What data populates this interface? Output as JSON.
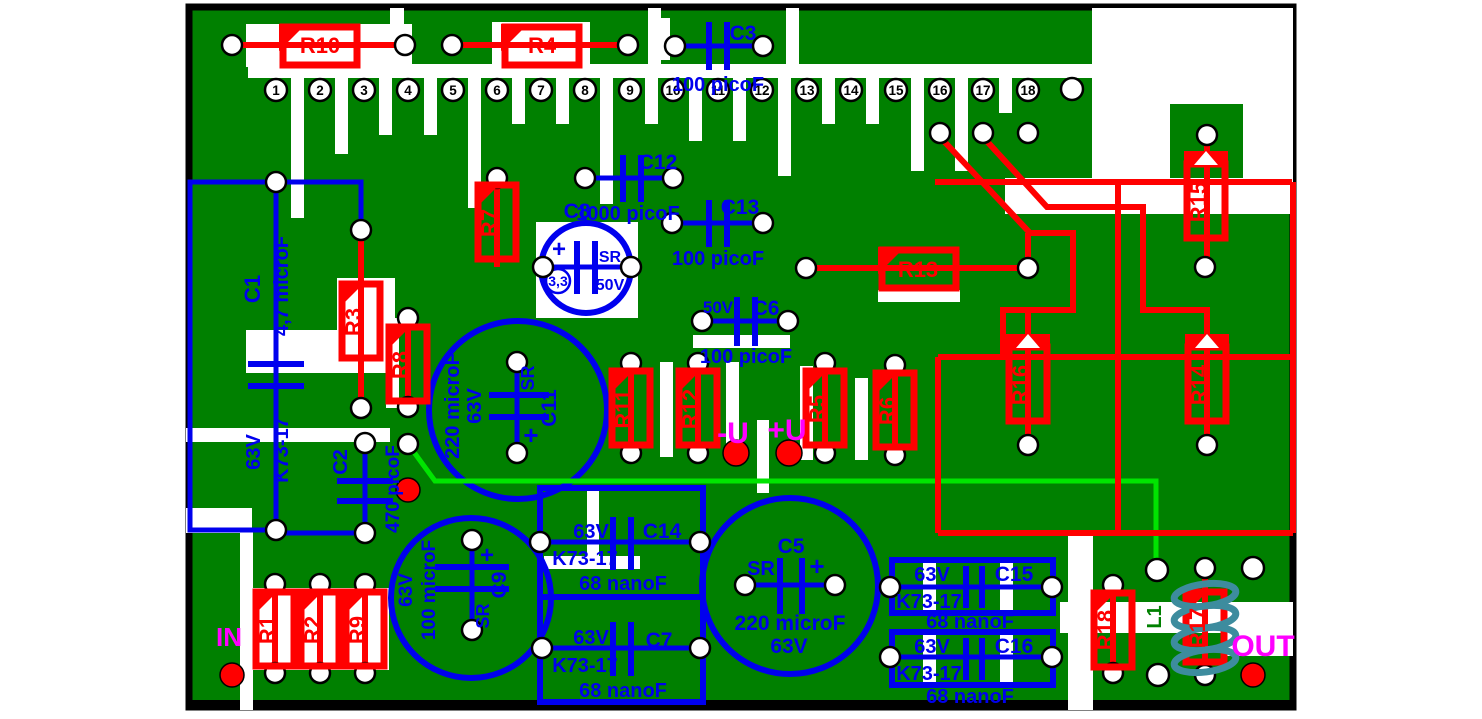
{
  "board": {
    "type": "pcb-component-layout",
    "colors": {
      "board_green": "#008000",
      "isolation_white": "#FFFFFF",
      "top_layer_red": "#FF0000",
      "bottom_layer_blue": "#0000EE",
      "jumper_green": "#00E400",
      "io_magenta": "#FF00FF",
      "pale_green_pad": "#CCFFCC",
      "coil_teal": "#3D8C9E",
      "border_black": "#000000"
    }
  },
  "pins": [
    {
      "n": "1",
      "fill": "#FF0000"
    },
    {
      "n": "2",
      "fill": "#FFFFFF"
    },
    {
      "n": "3",
      "fill": "#FFFFFF"
    },
    {
      "n": "4",
      "fill": "#FFFFFF"
    },
    {
      "n": "5",
      "fill": "#FFFFFF"
    },
    {
      "n": "6",
      "fill": "#FFFFFF"
    },
    {
      "n": "7",
      "fill": "#FFFFFF"
    },
    {
      "n": "8",
      "fill": "#CCFFCC"
    },
    {
      "n": "9",
      "fill": "#FFFFFF"
    },
    {
      "n": "10",
      "fill": "#FFFFFF"
    },
    {
      "n": "11",
      "fill": "#CCFFCC"
    },
    {
      "n": "12",
      "fill": "#FFFFFF"
    },
    {
      "n": "13",
      "fill": "#FF00FF"
    },
    {
      "n": "14",
      "fill": "#FFFFFF"
    },
    {
      "n": "15",
      "fill": "#FFFFFF"
    },
    {
      "n": "16",
      "fill": "#FF00FF"
    },
    {
      "n": "17",
      "fill": "#FF00FF"
    },
    {
      "n": "18",
      "fill": "#FF00FF"
    }
  ],
  "resistors": {
    "r1": {
      "label": "R1"
    },
    "r2": {
      "label": "R2"
    },
    "r3": {
      "label": "R3"
    },
    "r4": {
      "label": "R4"
    },
    "r5": {
      "label": "R5"
    },
    "r6": {
      "label": "R6"
    },
    "r7": {
      "label": "R7"
    },
    "r8": {
      "label": "R8"
    },
    "r9": {
      "label": "R9"
    },
    "r10": {
      "label": "R10"
    },
    "r11": {
      "label": "R11"
    },
    "r12": {
      "label": "R12"
    },
    "r13": {
      "label": "R13"
    },
    "r14": {
      "label": "R14"
    },
    "r15": {
      "label": "R15"
    },
    "r16": {
      "label": "R16"
    },
    "r17": {
      "label": "R17"
    },
    "r18": {
      "label": "R18"
    }
  },
  "capacitors": {
    "c1": {
      "name": "C1",
      "value": "4,7 microF",
      "voltage": "63V",
      "type": "K73-17"
    },
    "c2": {
      "name": "C2",
      "value": "470 picoF"
    },
    "c3": {
      "name": "C3",
      "value": "100 picoF"
    },
    "c5": {
      "name": "C5",
      "value": "220 microF",
      "voltage": "63V",
      "marking": "SR",
      "plus": "+"
    },
    "c6": {
      "name": "C6",
      "value": "100 picoF",
      "voltage": "50V"
    },
    "c7": {
      "name": "C7",
      "value": "68 nanoF",
      "voltage": "63V",
      "type": "K73-17"
    },
    "c8": {
      "name": "C8",
      "value": "3,3",
      "voltage": "50V",
      "marking": "SR",
      "plus": "+"
    },
    "c9": {
      "name": "C9",
      "value": "100 microF",
      "voltage": "63V",
      "marking": "SR",
      "plus": "+"
    },
    "c11": {
      "name": "C11",
      "value": "220 microF",
      "voltage": "63V",
      "marking": "SR",
      "plus": "+"
    },
    "c12": {
      "name": "C12",
      "value": "1000 picoF"
    },
    "c13": {
      "name": "C13",
      "value": "100 picoF"
    },
    "c14": {
      "name": "C14",
      "value": "68 nanoF",
      "voltage": "63V",
      "type": "K73-17"
    },
    "c15": {
      "name": "C15",
      "value": "68 nanoF",
      "voltage": "63V",
      "type": "K73-17"
    },
    "c16": {
      "name": "C16",
      "value": "68 nanoF",
      "voltage": "63V",
      "type": "K73-17"
    }
  },
  "inductor": {
    "label": "L1"
  },
  "io": {
    "in": "IN",
    "out": "OUT"
  },
  "power": {
    "minus": "-U",
    "plus": "+U"
  }
}
